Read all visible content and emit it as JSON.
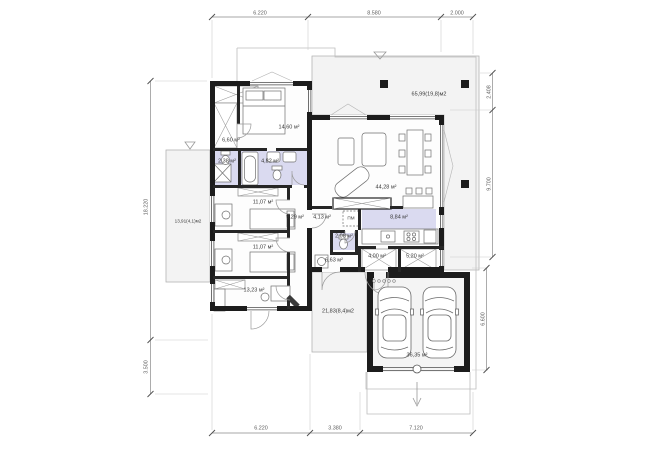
{
  "rooms": {
    "master_closet": "6,60 м²",
    "master_bedroom": "14,60 м²",
    "shower_room": "2,38 м²",
    "bathroom": "4,82 м²",
    "bedroom_2": "11,07 м²",
    "bedroom_3": "11,07 м²",
    "corridor": "9,29 м²",
    "office": "13,23 м²",
    "hallway": "4,13 м²",
    "wc": "2,08 м²",
    "kitchen": "8,84 м²",
    "living_dining": "44,28 м²",
    "utility": "6,63 м²",
    "entry": "4,00 м²",
    "pantry": "5,20 м²",
    "garage": "36,35 м²",
    "terrace_left": "13,91(4,1)м2",
    "terrace_south": "21,83(8,4)м2",
    "terrace_east": "65,99(19,8)м2"
  },
  "labels": {
    "appliance": "ПМ"
  },
  "dimensions": {
    "top": [
      "6.220",
      "8.580",
      "2.000"
    ],
    "bottom": [
      "6.220",
      "3.380",
      "7.120"
    ],
    "left": [
      "18.220",
      "3.500"
    ],
    "right": [
      "2.408",
      "9.700",
      "6.600"
    ]
  },
  "colors": {
    "wall": "#1c1c1c",
    "wet_room_fill": "#dadaf0",
    "terrace_fill": "#f3f3f3",
    "dimension_line": "#8a8a8a"
  }
}
